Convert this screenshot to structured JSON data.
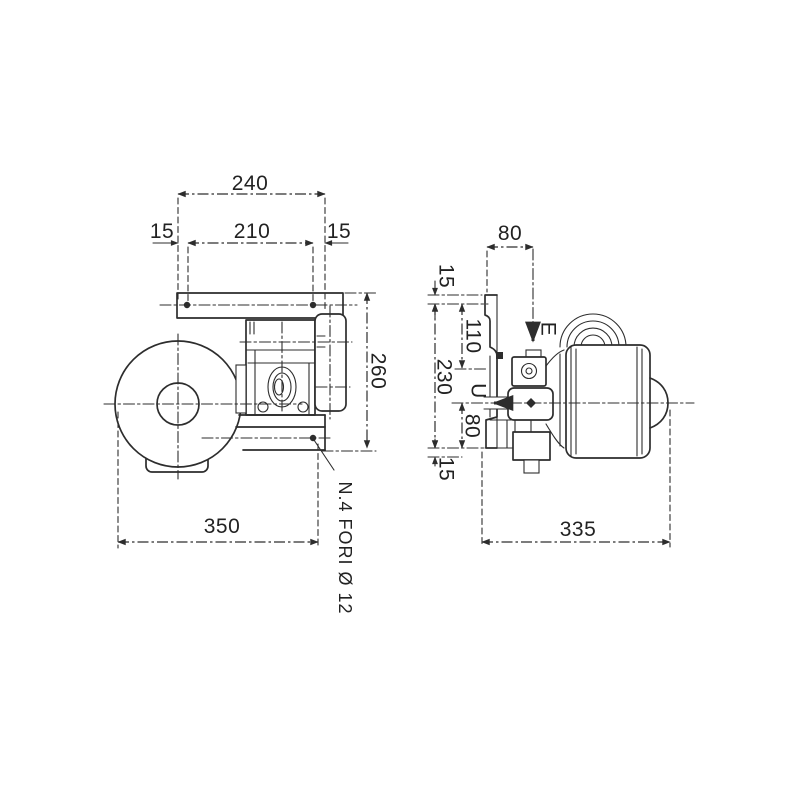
{
  "drawing": {
    "type": "technical-dimension-drawing",
    "colors": {
      "ink": "#2d2d2d",
      "background": "#ffffff"
    },
    "front_view": {
      "dim_overall_width_top": "240",
      "dim_edge_left": "15",
      "dim_hole_spacing": "210",
      "dim_edge_right": "15",
      "dim_overall_height": "260",
      "dim_overall_length": "350",
      "holes_note": "N.4 FORI Ø 12"
    },
    "side_view": {
      "dim_port_offset_top": "80",
      "dim_step_top": "15",
      "dim_110": "110",
      "dim_230": "230",
      "inlet_label": "E",
      "outlet_label": "U",
      "dim_80_bottom": "80",
      "dim_15_bottom": "15",
      "dim_overall_depth": "335"
    }
  }
}
